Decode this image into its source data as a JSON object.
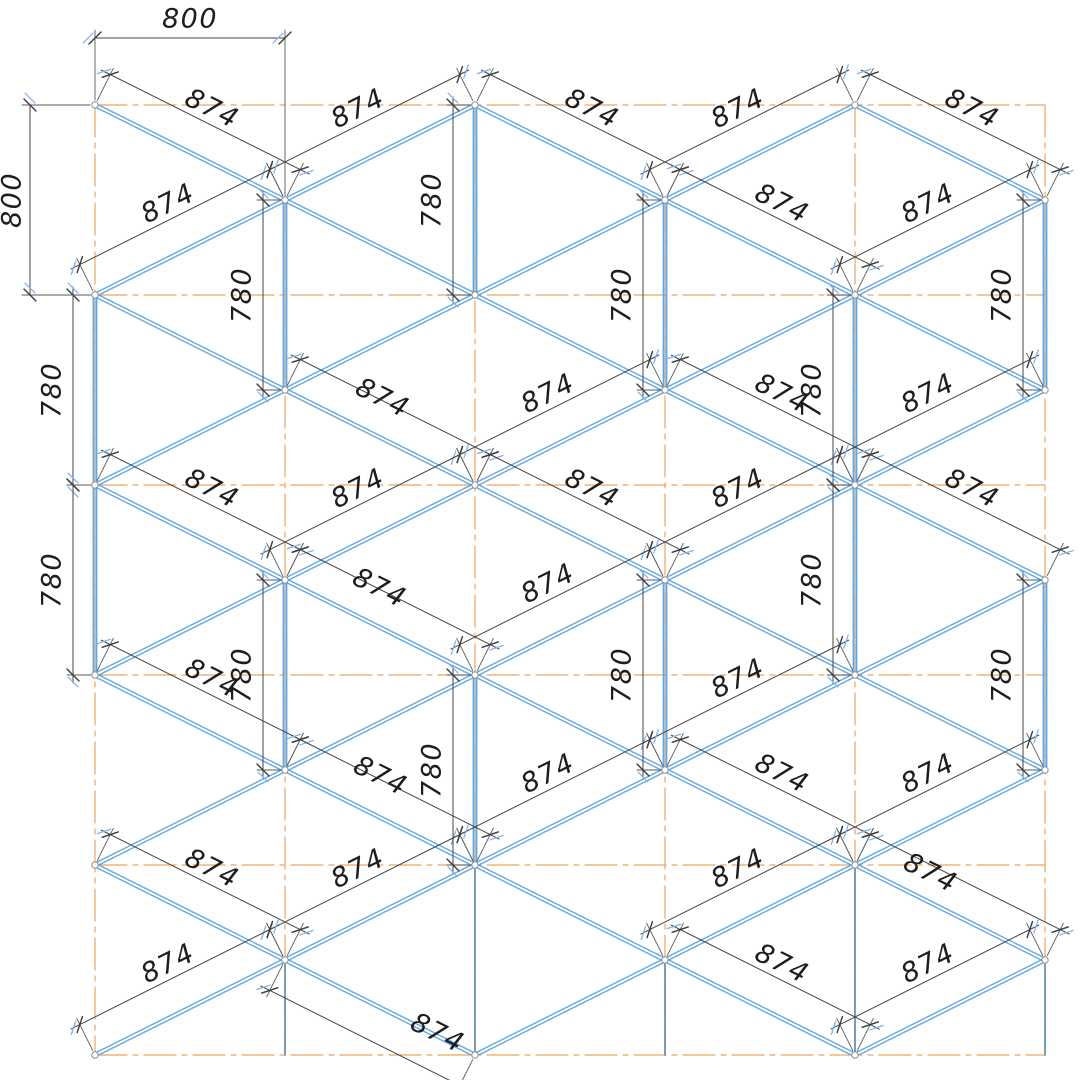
{
  "canvas": {
    "width": 1080,
    "height": 1080
  },
  "colors": {
    "background": "#ffffff",
    "grid_orange": "#f1a45f",
    "member_blue": "#62a7e4",
    "post_core": "#6a8a9e",
    "column_gray": "#6e93aa",
    "dim_line": "#454545",
    "ext_line": "#5a5a5a",
    "tick_black": "#3c3c3c",
    "tick_blue": "#7fb4ec",
    "node_stroke": "#8f8f8f",
    "node_fill": "#ffffff",
    "text": "#1d1d1d"
  },
  "text_style": {
    "font_size": 27,
    "letter_spacing": 1.5
  },
  "grid": {
    "verticals": [
      {
        "x": 95,
        "y1": 105,
        "y2": 1055
      },
      {
        "x": 285,
        "y1": 200,
        "y2": 1055
      },
      {
        "x": 475,
        "y1": 105,
        "y2": 1055
      },
      {
        "x": 665,
        "y1": 200,
        "y2": 1055
      },
      {
        "x": 855,
        "y1": 105,
        "y2": 1055
      },
      {
        "x": 1045,
        "y1": 105,
        "y2": 1055
      }
    ],
    "horizontals": [
      {
        "y": 105,
        "x1": 95,
        "x2": 1045
      },
      {
        "y": 295,
        "x1": 95,
        "x2": 1045
      },
      {
        "y": 485,
        "x1": 95,
        "x2": 1045
      },
      {
        "y": 675,
        "x1": 95,
        "x2": 1045
      },
      {
        "y": 865,
        "x1": 95,
        "x2": 1045
      },
      {
        "y": 1055,
        "x1": 95,
        "x2": 1045
      }
    ]
  },
  "nodes": {
    "even_x": [
      95,
      475,
      855
    ],
    "even_y": [
      105,
      295,
      485,
      675,
      865,
      1055
    ],
    "odd_x": [
      285,
      665,
      1045
    ],
    "odd_y": [
      200,
      390,
      580,
      770,
      960
    ]
  },
  "members": [
    [
      95,
      105,
      285,
      200
    ],
    [
      95,
      295,
      285,
      390
    ],
    [
      95,
      485,
      285,
      580
    ],
    [
      95,
      675,
      285,
      770
    ],
    [
      95,
      865,
      285,
      960
    ],
    [
      95,
      295,
      285,
      200
    ],
    [
      95,
      485,
      285,
      390
    ],
    [
      95,
      675,
      285,
      580
    ],
    [
      95,
      865,
      285,
      770
    ],
    [
      95,
      1055,
      285,
      960
    ],
    [
      285,
      200,
      475,
      295
    ],
    [
      285,
      390,
      475,
      485
    ],
    [
      285,
      580,
      475,
      675
    ],
    [
      285,
      770,
      475,
      865
    ],
    [
      285,
      960,
      475,
      1055
    ],
    [
      285,
      200,
      475,
      105
    ],
    [
      285,
      390,
      475,
      295
    ],
    [
      285,
      580,
      475,
      485
    ],
    [
      285,
      770,
      475,
      675
    ],
    [
      285,
      960,
      475,
      865
    ],
    [
      475,
      105,
      665,
      200
    ],
    [
      475,
      295,
      665,
      390
    ],
    [
      475,
      485,
      665,
      580
    ],
    [
      475,
      675,
      665,
      770
    ],
    [
      475,
      865,
      665,
      960
    ],
    [
      475,
      295,
      665,
      200
    ],
    [
      475,
      485,
      665,
      390
    ],
    [
      475,
      675,
      665,
      580
    ],
    [
      475,
      865,
      665,
      770
    ],
    [
      475,
      1055,
      665,
      960
    ],
    [
      665,
      200,
      855,
      295
    ],
    [
      665,
      390,
      855,
      485
    ],
    [
      665,
      580,
      855,
      675
    ],
    [
      665,
      770,
      855,
      865
    ],
    [
      665,
      960,
      855,
      1055
    ],
    [
      665,
      200,
      855,
      105
    ],
    [
      665,
      390,
      855,
      295
    ],
    [
      665,
      580,
      855,
      485
    ],
    [
      665,
      770,
      855,
      675
    ],
    [
      665,
      960,
      855,
      865
    ],
    [
      855,
      105,
      1045,
      200
    ],
    [
      855,
      295,
      1045,
      390
    ],
    [
      855,
      485,
      1045,
      580
    ],
    [
      855,
      675,
      1045,
      770
    ],
    [
      855,
      865,
      1045,
      960
    ],
    [
      855,
      295,
      1045,
      200
    ],
    [
      855,
      485,
      1045,
      390
    ],
    [
      855,
      675,
      1045,
      580
    ],
    [
      855,
      865,
      1045,
      770
    ],
    [
      855,
      1055,
      1045,
      960
    ]
  ],
  "posts": [
    [
      285,
      200,
      390
    ],
    [
      475,
      105,
      295
    ],
    [
      665,
      200,
      390
    ],
    [
      1045,
      200,
      390
    ],
    [
      95,
      295,
      485
    ],
    [
      855,
      295,
      485
    ],
    [
      95,
      485,
      675
    ],
    [
      855,
      485,
      675
    ],
    [
      285,
      580,
      770
    ],
    [
      665,
      580,
      770
    ],
    [
      1045,
      580,
      770
    ],
    [
      475,
      675,
      865
    ]
  ],
  "columns": [
    [
      285,
      960,
      1055
    ],
    [
      475,
      865,
      1055
    ],
    [
      665,
      960,
      1055
    ],
    [
      855,
      865,
      1055
    ],
    [
      1045,
      960,
      1055
    ]
  ],
  "dims": {
    "diagonal": [
      {
        "d": "dr",
        "m": [
          95,
          105,
          285,
          200
        ],
        "label": "874"
      },
      {
        "d": "ur",
        "m": [
          285,
          200,
          475,
          105
        ],
        "label": "874"
      },
      {
        "d": "dr",
        "m": [
          475,
          105,
          665,
          200
        ],
        "label": "874"
      },
      {
        "d": "ur",
        "m": [
          665,
          200,
          855,
          105
        ],
        "label": "874"
      },
      {
        "d": "dr",
        "m": [
          855,
          105,
          1045,
          200
        ],
        "label": "874"
      },
      {
        "d": "ur",
        "m": [
          95,
          295,
          285,
          200
        ],
        "label": "874"
      },
      {
        "d": "dr",
        "m": [
          665,
          200,
          855,
          295
        ],
        "label": "874"
      },
      {
        "d": "ur",
        "m": [
          855,
          295,
          1045,
          200
        ],
        "label": "874"
      },
      {
        "d": "dr",
        "m": [
          285,
          390,
          475,
          485
        ],
        "label": "874",
        "lp": [
          382,
          399
        ]
      },
      {
        "d": "ur",
        "m": [
          475,
          485,
          665,
          390
        ],
        "label": "874"
      },
      {
        "d": "dr",
        "m": [
          665,
          390,
          855,
          485
        ],
        "label": "874"
      },
      {
        "d": "ur",
        "m": [
          855,
          485,
          1045,
          390
        ],
        "label": "874"
      },
      {
        "d": "dr",
        "m": [
          95,
          485,
          285,
          580
        ],
        "label": "874"
      },
      {
        "d": "ur",
        "m": [
          285,
          580,
          475,
          485
        ],
        "label": "874"
      },
      {
        "d": "dr",
        "m": [
          475,
          485,
          665,
          580
        ],
        "label": "874"
      },
      {
        "d": "ur",
        "m": [
          665,
          580,
          855,
          485
        ],
        "label": "874"
      },
      {
        "d": "dr",
        "m": [
          855,
          485,
          1045,
          580
        ],
        "label": "874"
      },
      {
        "d": "dr",
        "m": [
          285,
          580,
          475,
          675
        ],
        "label": "874",
        "lp": [
          379,
          589
        ]
      },
      {
        "d": "ur",
        "m": [
          475,
          675,
          665,
          580
        ],
        "label": "874"
      },
      {
        "d": "dr",
        "m": [
          95,
          675,
          285,
          770
        ],
        "label": "874"
      },
      {
        "d": "ur",
        "m": [
          665,
          770,
          855,
          675
        ],
        "label": "874"
      },
      {
        "d": "dr",
        "m": [
          285,
          770,
          475,
          865
        ],
        "label": "874",
        "lp": [
          380,
          777
        ]
      },
      {
        "d": "ur",
        "m": [
          475,
          865,
          665,
          770
        ],
        "label": "874"
      },
      {
        "d": "dr",
        "m": [
          665,
          770,
          855,
          865
        ],
        "label": "874"
      },
      {
        "d": "ur",
        "m": [
          855,
          865,
          1045,
          770
        ],
        "label": "874"
      },
      {
        "d": "dr",
        "m": [
          95,
          865,
          285,
          960
        ],
        "label": "874"
      },
      {
        "d": "ur",
        "m": [
          285,
          960,
          475,
          865
        ],
        "label": "874"
      },
      {
        "d": "ur",
        "m": [
          665,
          960,
          855,
          865
        ],
        "label": "874"
      },
      {
        "d": "dr",
        "m": [
          855,
          865,
          1045,
          960
        ],
        "label": "874",
        "lp": [
          930,
          874
        ]
      },
      {
        "d": "ur",
        "m": [
          95,
          1055,
          285,
          960
        ],
        "label": "874"
      },
      {
        "d": "dr",
        "m": [
          285,
          960,
          475,
          1055
        ],
        "label": "874",
        "side": -1,
        "lp": [
          437,
          1034
        ]
      },
      {
        "d": "dr",
        "m": [
          665,
          960,
          855,
          1055
        ],
        "label": "874"
      },
      {
        "d": "ur",
        "m": [
          855,
          1055,
          1045,
          960
        ],
        "label": "874"
      }
    ],
    "posts": [
      {
        "x": 285,
        "y1": 200,
        "y2": 390,
        "label": "780"
      },
      {
        "x": 475,
        "y1": 105,
        "y2": 295,
        "label": "780"
      },
      {
        "x": 665,
        "y1": 200,
        "y2": 390,
        "label": "780"
      },
      {
        "x": 1045,
        "y1": 200,
        "y2": 390,
        "label": "780"
      },
      {
        "x": 95,
        "y1": 295,
        "y2": 485,
        "label": "780"
      },
      {
        "x": 855,
        "y1": 295,
        "y2": 485,
        "label": "780"
      },
      {
        "x": 95,
        "y1": 485,
        "y2": 675,
        "label": "780"
      },
      {
        "x": 855,
        "y1": 485,
        "y2": 675,
        "label": "780"
      },
      {
        "x": 285,
        "y1": 580,
        "y2": 770,
        "label": "780"
      },
      {
        "x": 665,
        "y1": 580,
        "y2": 770,
        "label": "780"
      },
      {
        "x": 1045,
        "y1": 580,
        "y2": 770,
        "label": "780"
      },
      {
        "x": 475,
        "y1": 675,
        "y2": 865,
        "label": "780"
      }
    ],
    "linear": [
      {
        "label": "800",
        "text_pos": [
          190,
          20
        ],
        "text_rot": 0,
        "line": [
          95,
          38,
          285,
          38
        ],
        "exts": [
          [
            95,
            100,
            95,
            30
          ],
          [
            285,
            196,
            285,
            30
          ]
        ],
        "ticks": [
          [
            95,
            38
          ],
          [
            285,
            38
          ]
        ],
        "tick_angle": -45
      },
      {
        "label": "800",
        "text_pos": [
          13,
          200
        ],
        "text_rot": -90,
        "line": [
          30,
          105,
          30,
          295
        ],
        "exts": [
          [
            90,
            105,
            22,
            105
          ],
          [
            90,
            295,
            22,
            295
          ]
        ],
        "ticks": [
          [
            30,
            105
          ],
          [
            30,
            295
          ]
        ],
        "tick_angle": 45
      }
    ]
  }
}
